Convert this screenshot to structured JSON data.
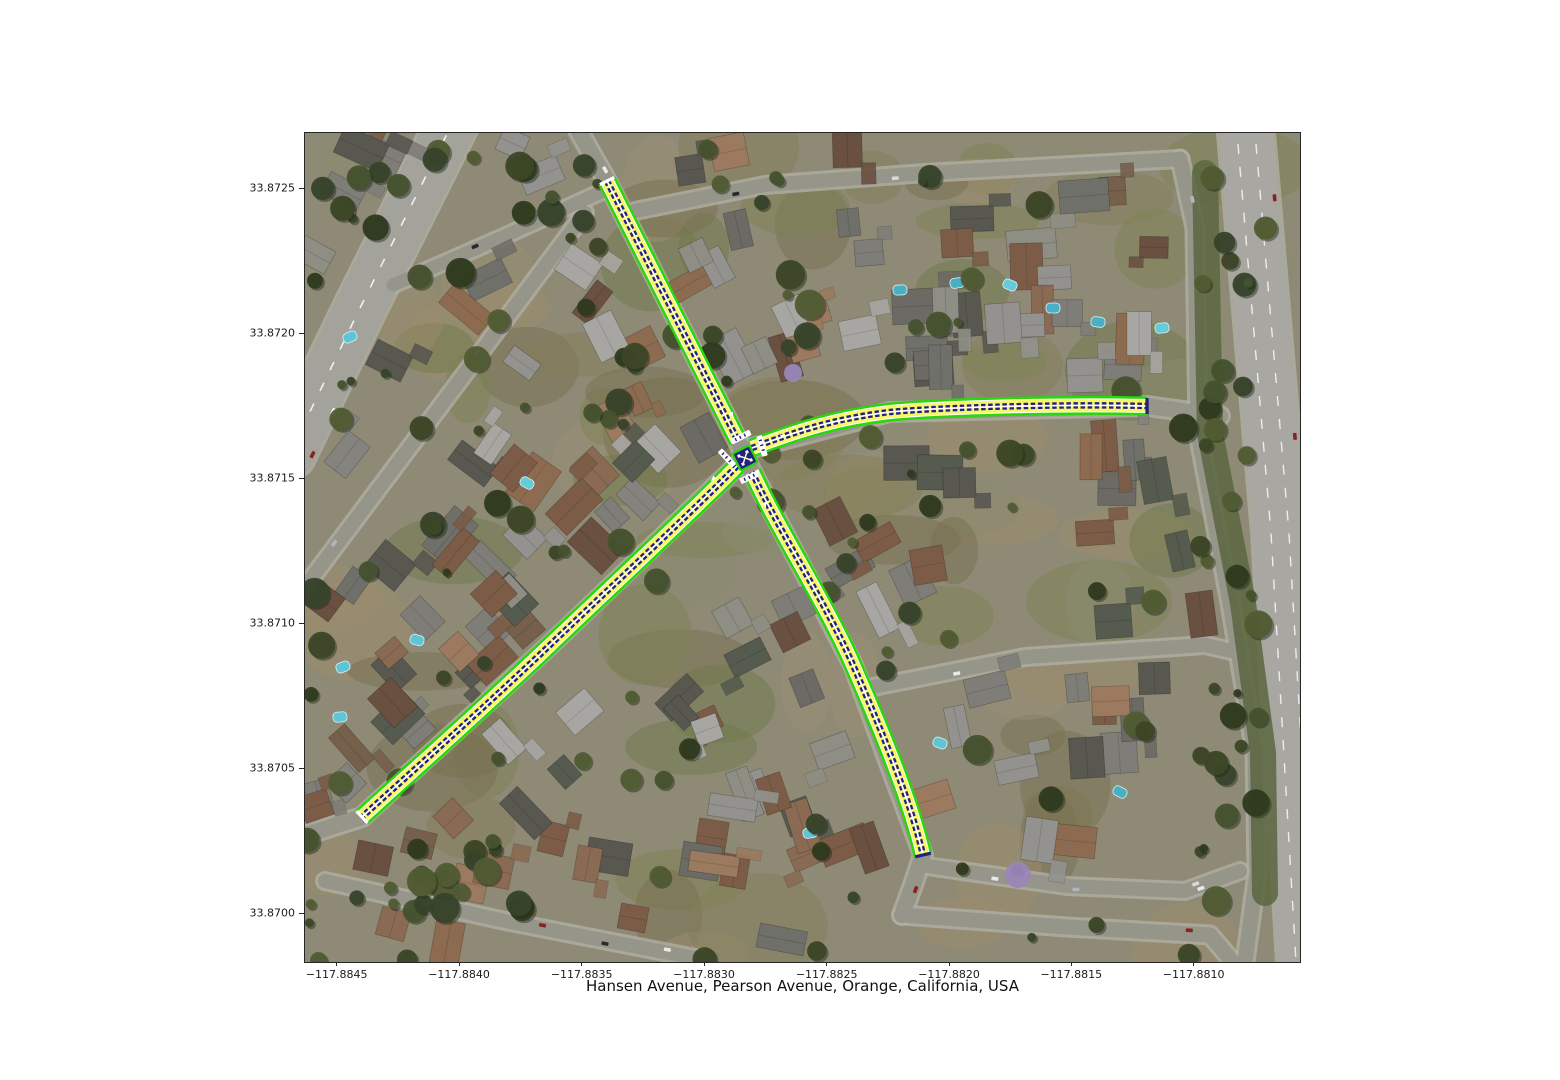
{
  "figure": {
    "xlabel": "Hansen Avenue, Pearson Avenue, Orange, California, USA",
    "x_tick_labels": [
      "−117.8845",
      "−117.8840",
      "−117.8835",
      "−117.8830",
      "−117.8825",
      "−117.8820",
      "−117.8815",
      "−117.8810"
    ],
    "y_tick_labels": [
      "33.8725",
      "33.8720",
      "33.8715",
      "33.8710",
      "33.8705",
      "33.8700"
    ],
    "tick_color": "#1a1a1a",
    "frame_color": "#262626"
  },
  "map": {
    "description": "aerial satellite imagery of a residential neighborhood with highlighted street segments meeting at a four-way intersection",
    "location": {
      "roads": [
        "Hansen Avenue",
        "Pearson Avenue"
      ],
      "city": "Orange",
      "state": "California",
      "country": "USA"
    },
    "overlay": {
      "road_casing_color": "#2bd60b",
      "lane_fill_color": "#f9f669",
      "lane_edge_color": "#ffffff",
      "centerline_color": "#23237d",
      "stop_line_color": "#ffffff",
      "arms": [
        "north",
        "east",
        "southwest",
        "south"
      ]
    }
  }
}
